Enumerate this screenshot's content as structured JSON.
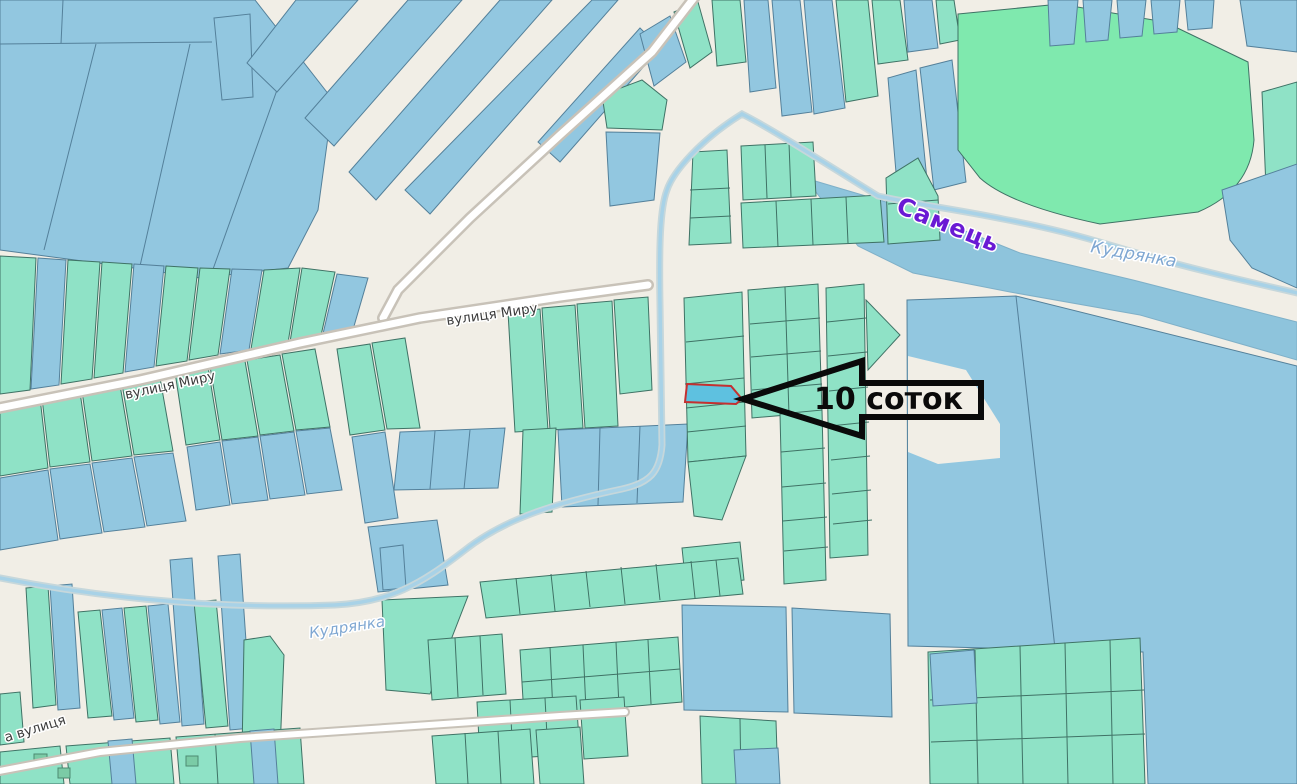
{
  "map": {
    "labels": {
      "river_samets": "Самець",
      "stream_kudrianka_upper": "Кудрянка",
      "stream_kudrianka_lower": "Кудрянка",
      "street_myru_west": "вулиця Миру",
      "street_myru_east": "вулиця Миру",
      "street_partial_southwest": "а вулиця"
    },
    "annotation": {
      "label": "10 соток"
    },
    "colors": {
      "background": "#f1eee6",
      "parcel_blue": "#92c7e0",
      "parcel_teal": "#8fe2c6",
      "parcel_border_blue": "#54809a",
      "parcel_border_teal": "#3f7265",
      "field_green": "#7fe9ae",
      "water": "#8ec4dc",
      "stream": "#a8d2e7",
      "stream_casing": "#c6d7db",
      "road_fill": "#ffffff",
      "road_casing": "#c8c2b8",
      "building_fill": "#7bcba6",
      "highlight_fill": "#5ec1e0",
      "highlight_outline": "#c43030",
      "label_river": "#6a1ad4",
      "label_stream": "#7fa7d2",
      "label_street": "#3c3c3c",
      "annotation_color": "#0a0a0a"
    }
  }
}
